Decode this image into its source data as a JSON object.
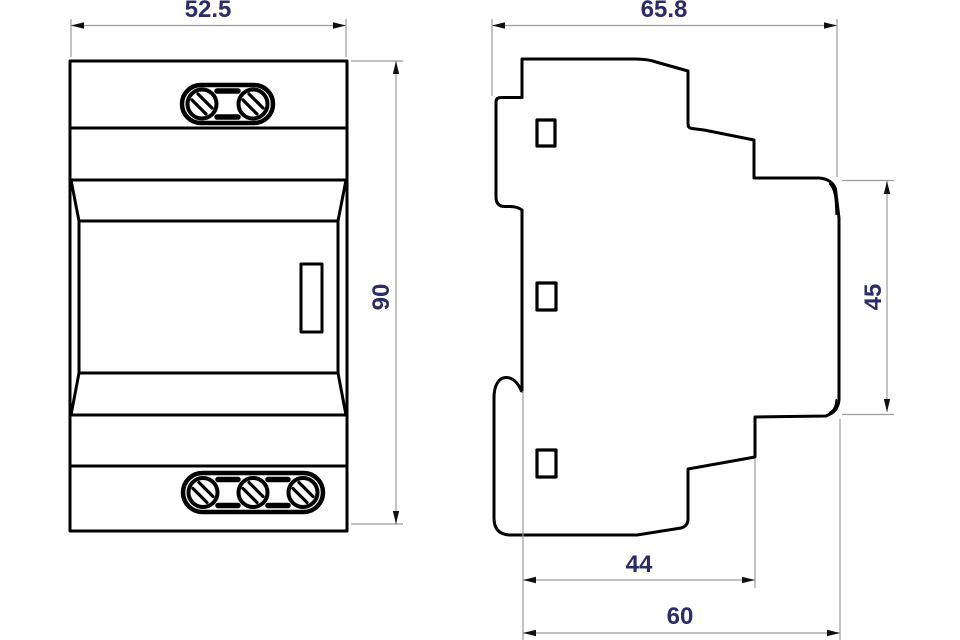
{
  "dimensions": {
    "front_width": "52.5",
    "front_height": "90",
    "side_width": "65.8",
    "face_height": "45",
    "depth_body": "44",
    "depth_total": "60"
  },
  "colors": {
    "outline": "#000000",
    "dimension_line": "#9b9b9b",
    "dimension_text": "#2b2b6a",
    "arrow": "#111111"
  }
}
